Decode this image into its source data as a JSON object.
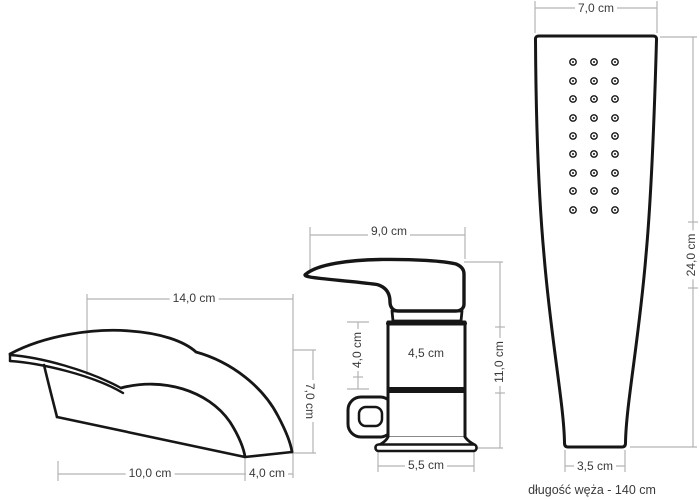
{
  "colors": {
    "outline": "#161616",
    "dimension": "#b3b3b3",
    "label": "#3a3a3a",
    "background": "#ffffff"
  },
  "spout": {
    "top_width": "14,0 cm",
    "front_height": "7,0 cm",
    "bottom_length": "10,0 cm",
    "bottom_depth": "4,0 cm"
  },
  "mixer": {
    "handle_width": "9,0 cm",
    "upper_body_height": "4,0 cm",
    "body_width": "4,5 cm",
    "total_height": "11,0 cm",
    "base_width": "5,5 cm"
  },
  "shower": {
    "head_width": "7,0 cm",
    "total_height": "24,0 cm",
    "bottom_width": "3,5 cm",
    "hose_note": "długość węża - 140 cm"
  }
}
